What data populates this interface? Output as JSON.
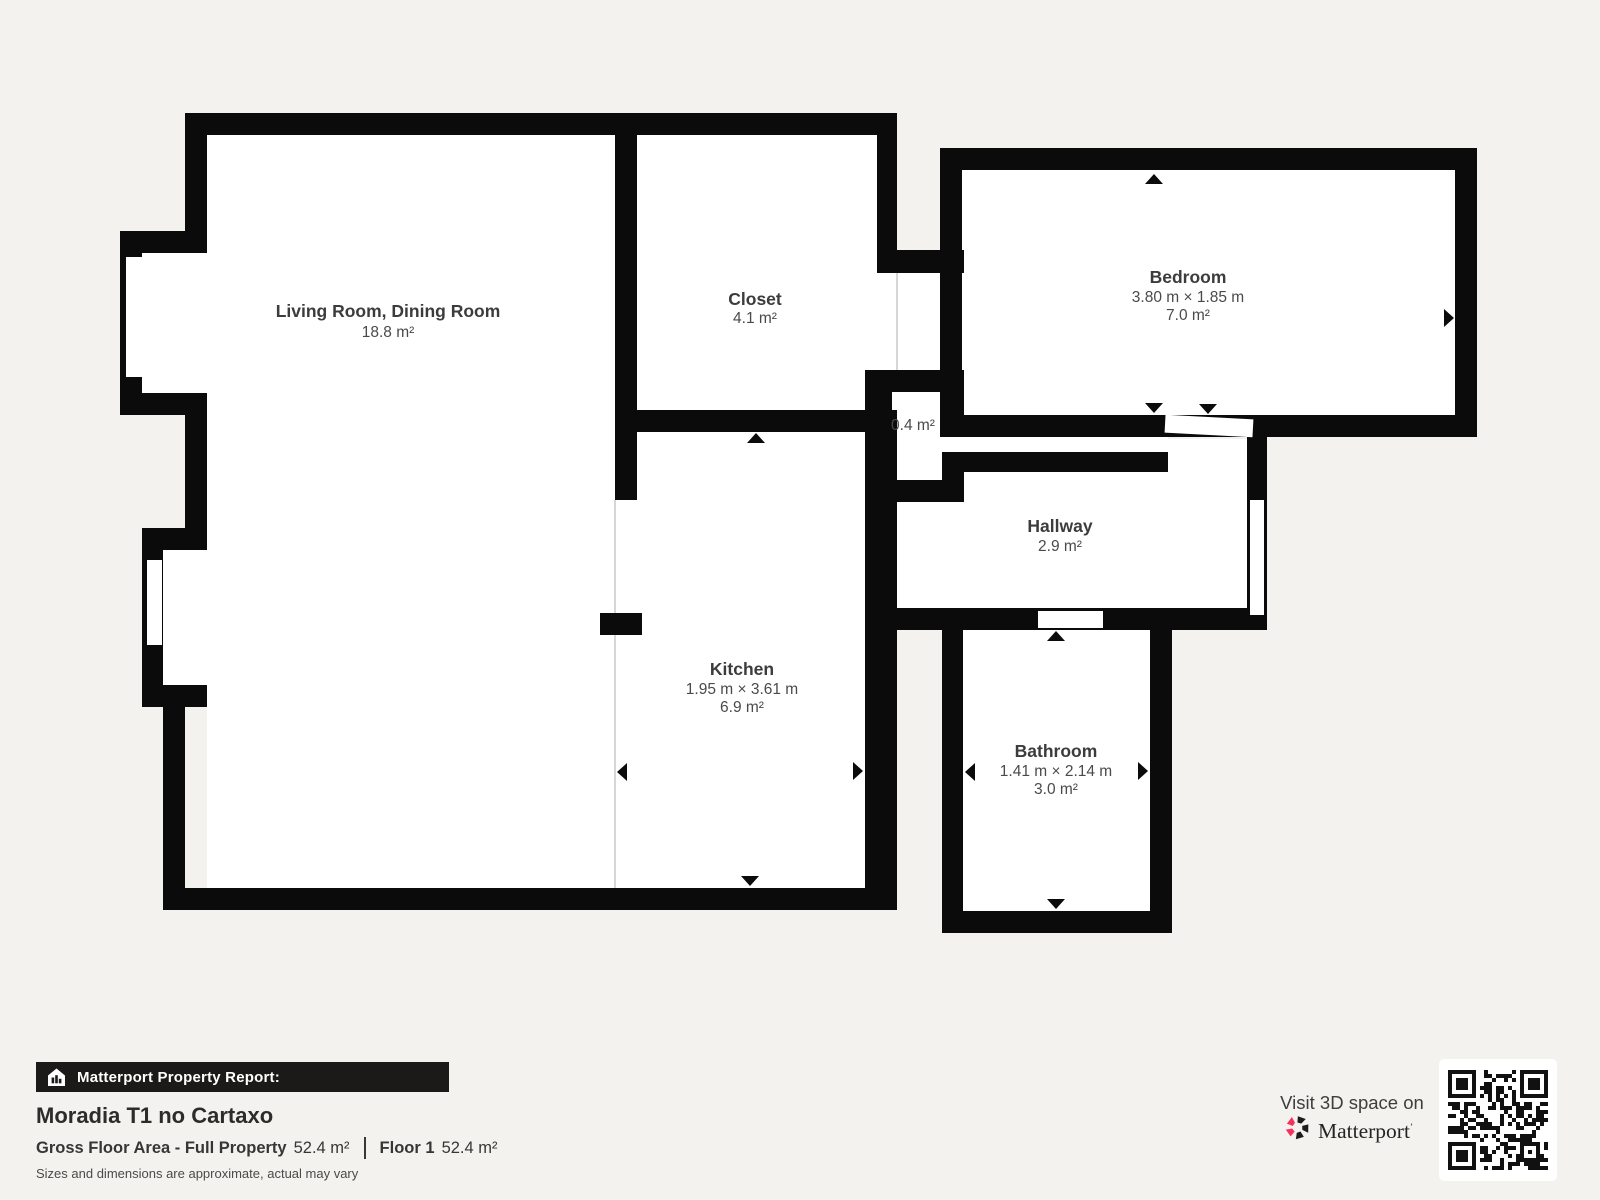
{
  "page": {
    "bg": "#f3f2ef"
  },
  "floorplan": {
    "wall_color": "#0b0b0b",
    "room_fill": "#ffffff",
    "line_color": "#c9c9c6",
    "interiors": [
      {
        "name": "living-room",
        "rect": [
          207,
          135,
          408,
          753
        ]
      },
      {
        "name": "living-room-bay-1",
        "rect": [
          142,
          253,
          65,
          140
        ]
      },
      {
        "name": "living-room-bay-2",
        "rect": [
          163,
          550,
          44,
          135
        ]
      },
      {
        "name": "closet",
        "rect": [
          637,
          135,
          240,
          275
        ]
      },
      {
        "name": "closet-nook",
        "rect": [
          877,
          273,
          63,
          97
        ]
      },
      {
        "name": "small-closet",
        "rect": [
          892,
          392,
          50,
          88
        ]
      },
      {
        "name": "kitchen",
        "rect": [
          615,
          432,
          250,
          456
        ]
      },
      {
        "name": "bedroom",
        "rect": [
          962,
          170,
          493,
          245
        ]
      },
      {
        "name": "hallway",
        "poly": [
          [
            895,
            608
          ],
          [
            895,
            502
          ],
          [
            963,
            502
          ],
          [
            963,
            472
          ],
          [
            1168,
            472
          ],
          [
            1168,
            439
          ],
          [
            1247,
            439
          ],
          [
            1247,
            608
          ]
        ]
      },
      {
        "name": "bathroom",
        "rect": [
          963,
          630,
          187,
          281
        ]
      }
    ],
    "walls": [
      [
        185,
        113,
        712,
        22
      ],
      [
        185,
        113,
        22,
        140
      ],
      [
        120,
        231,
        87,
        22
      ],
      [
        120,
        231,
        22,
        184
      ],
      [
        120,
        393,
        87,
        22
      ],
      [
        185,
        393,
        22,
        157
      ],
      [
        142,
        528,
        65,
        22
      ],
      [
        142,
        528,
        21,
        179
      ],
      [
        142,
        685,
        65,
        22
      ],
      [
        163,
        685,
        22,
        225
      ],
      [
        163,
        888,
        714,
        22
      ],
      [
        865,
        410,
        32,
        500
      ],
      [
        615,
        113,
        22,
        387
      ],
      [
        615,
        410,
        282,
        22
      ],
      [
        877,
        113,
        20,
        140
      ],
      [
        877,
        250,
        87,
        23
      ],
      [
        600,
        613,
        42,
        22
      ],
      [
        865,
        370,
        99,
        22
      ],
      [
        865,
        370,
        27,
        132
      ],
      [
        865,
        480,
        99,
        22
      ],
      [
        942,
        392,
        22,
        88
      ],
      [
        940,
        148,
        537,
        22
      ],
      [
        940,
        148,
        22,
        289
      ],
      [
        1455,
        148,
        22,
        289
      ],
      [
        940,
        415,
        537,
        22
      ],
      [
        942,
        452,
        226,
        20
      ],
      [
        1247,
        437,
        20,
        193
      ],
      [
        865,
        608,
        402,
        22
      ],
      [
        942,
        630,
        21,
        303
      ],
      [
        1150,
        608,
        22,
        325
      ],
      [
        942,
        911,
        230,
        22
      ]
    ],
    "openings": [
      {
        "name": "living-room-window-1",
        "rect": [
          126,
          257,
          16,
          120
        ],
        "rotate": 0
      },
      {
        "name": "living-room-window-2",
        "rect": [
          147,
          560,
          15,
          85
        ],
        "rotate": 0
      },
      {
        "name": "corridor-passage",
        "rect": [
          942,
          437,
          226,
          15
        ],
        "rotate": 0
      },
      {
        "name": "bedroom-door-opening",
        "rect": [
          1165,
          417,
          88,
          18
        ],
        "rotate": 3
      },
      {
        "name": "hallway-entry-opening",
        "rect": [
          1250,
          500,
          14,
          115
        ],
        "rotate": 0
      },
      {
        "name": "bathroom-door-opening",
        "rect": [
          1038,
          611,
          65,
          17
        ],
        "rotate": 0
      }
    ],
    "lines": [
      [
        615,
        500,
        615,
        613
      ],
      [
        615,
        635,
        615,
        888
      ],
      [
        897,
        273,
        897,
        370
      ]
    ],
    "arrows": [
      {
        "name": "kitchen-width-arrow-left",
        "dir": "left",
        "tip": [
          617,
          772
        ]
      },
      {
        "name": "kitchen-width-arrow-right",
        "dir": "right",
        "tip": [
          863,
          771
        ]
      },
      {
        "name": "kitchen-depth-arrow-top",
        "dir": "up",
        "tip": [
          756,
          433
        ]
      },
      {
        "name": "kitchen-depth-arrow-bottom",
        "dir": "down",
        "tip": [
          750,
          886
        ]
      },
      {
        "name": "bedroom-width-arrow-left",
        "dir": "left",
        "tip": [
          942,
          321
        ]
      },
      {
        "name": "bedroom-width-arrow-right",
        "dir": "right",
        "tip": [
          1454,
          318
        ]
      },
      {
        "name": "bedroom-depth-arrow-top",
        "dir": "up",
        "tip": [
          1154,
          174
        ]
      },
      {
        "name": "bedroom-depth-arrow-bottom",
        "dir": "down",
        "tip": [
          1154,
          413
        ]
      },
      {
        "name": "bathroom-width-arrow-left",
        "dir": "left",
        "tip": [
          965,
          772
        ]
      },
      {
        "name": "bathroom-width-arrow-right",
        "dir": "right",
        "tip": [
          1148,
          771
        ]
      },
      {
        "name": "bathroom-depth-arrow-top",
        "dir": "up",
        "tip": [
          1056,
          631
        ]
      },
      {
        "name": "bathroom-depth-arrow-bottom",
        "dir": "down",
        "tip": [
          1056,
          909
        ]
      },
      {
        "name": "bedroom-door-arrow",
        "dir": "down",
        "tip": [
          1208,
          414
        ]
      }
    ],
    "labels": [
      {
        "name": "living-room",
        "x": 388,
        "title": "Living Room, Dining Room",
        "title_y": 317,
        "lines": [
          [
            "18.8 m²",
            337
          ]
        ]
      },
      {
        "name": "closet",
        "x": 755,
        "title": "Closet",
        "title_y": 305,
        "lines": [
          [
            "4.1 m²",
            323
          ]
        ]
      },
      {
        "name": "bedroom",
        "x": 1188,
        "title": "Bedroom",
        "title_y": 283,
        "lines": [
          [
            "3.80 m × 1.85 m",
            302
          ],
          [
            "7.0 m²",
            320
          ]
        ]
      },
      {
        "name": "small-closet",
        "x": 913,
        "title": "",
        "title_y": 0,
        "lines": [
          [
            "0.4 m²",
            430
          ]
        ]
      },
      {
        "name": "hallway",
        "x": 1060,
        "title": "Hallway",
        "title_y": 532,
        "lines": [
          [
            "2.9 m²",
            551
          ]
        ]
      },
      {
        "name": "kitchen",
        "x": 742,
        "title": "Kitchen",
        "title_y": 675,
        "lines": [
          [
            "1.95 m × 3.61 m",
            694
          ],
          [
            "6.9 m²",
            712
          ]
        ]
      },
      {
        "name": "bathroom",
        "x": 1056,
        "title": "Bathroom",
        "title_y": 757,
        "lines": [
          [
            "1.41 m × 2.14 m",
            776
          ],
          [
            "3.0 m²",
            794
          ]
        ]
      }
    ]
  },
  "footer": {
    "report_label": "Matterport Property Report:",
    "property_title": "Moradia T1 no Cartaxo",
    "gfa_label": "Gross Floor Area - Full Property",
    "gfa_value": "52.4 m²",
    "floor_label": "Floor 1",
    "floor_value": "52.4 m²",
    "disclaimer": "Sizes and dimensions are approximate, actual may vary"
  },
  "cta": {
    "visit_text": "Visit 3D space on",
    "brand": "Matterport",
    "brand_pink": "#f5325b",
    "brand_dark": "#1e1c1b"
  }
}
